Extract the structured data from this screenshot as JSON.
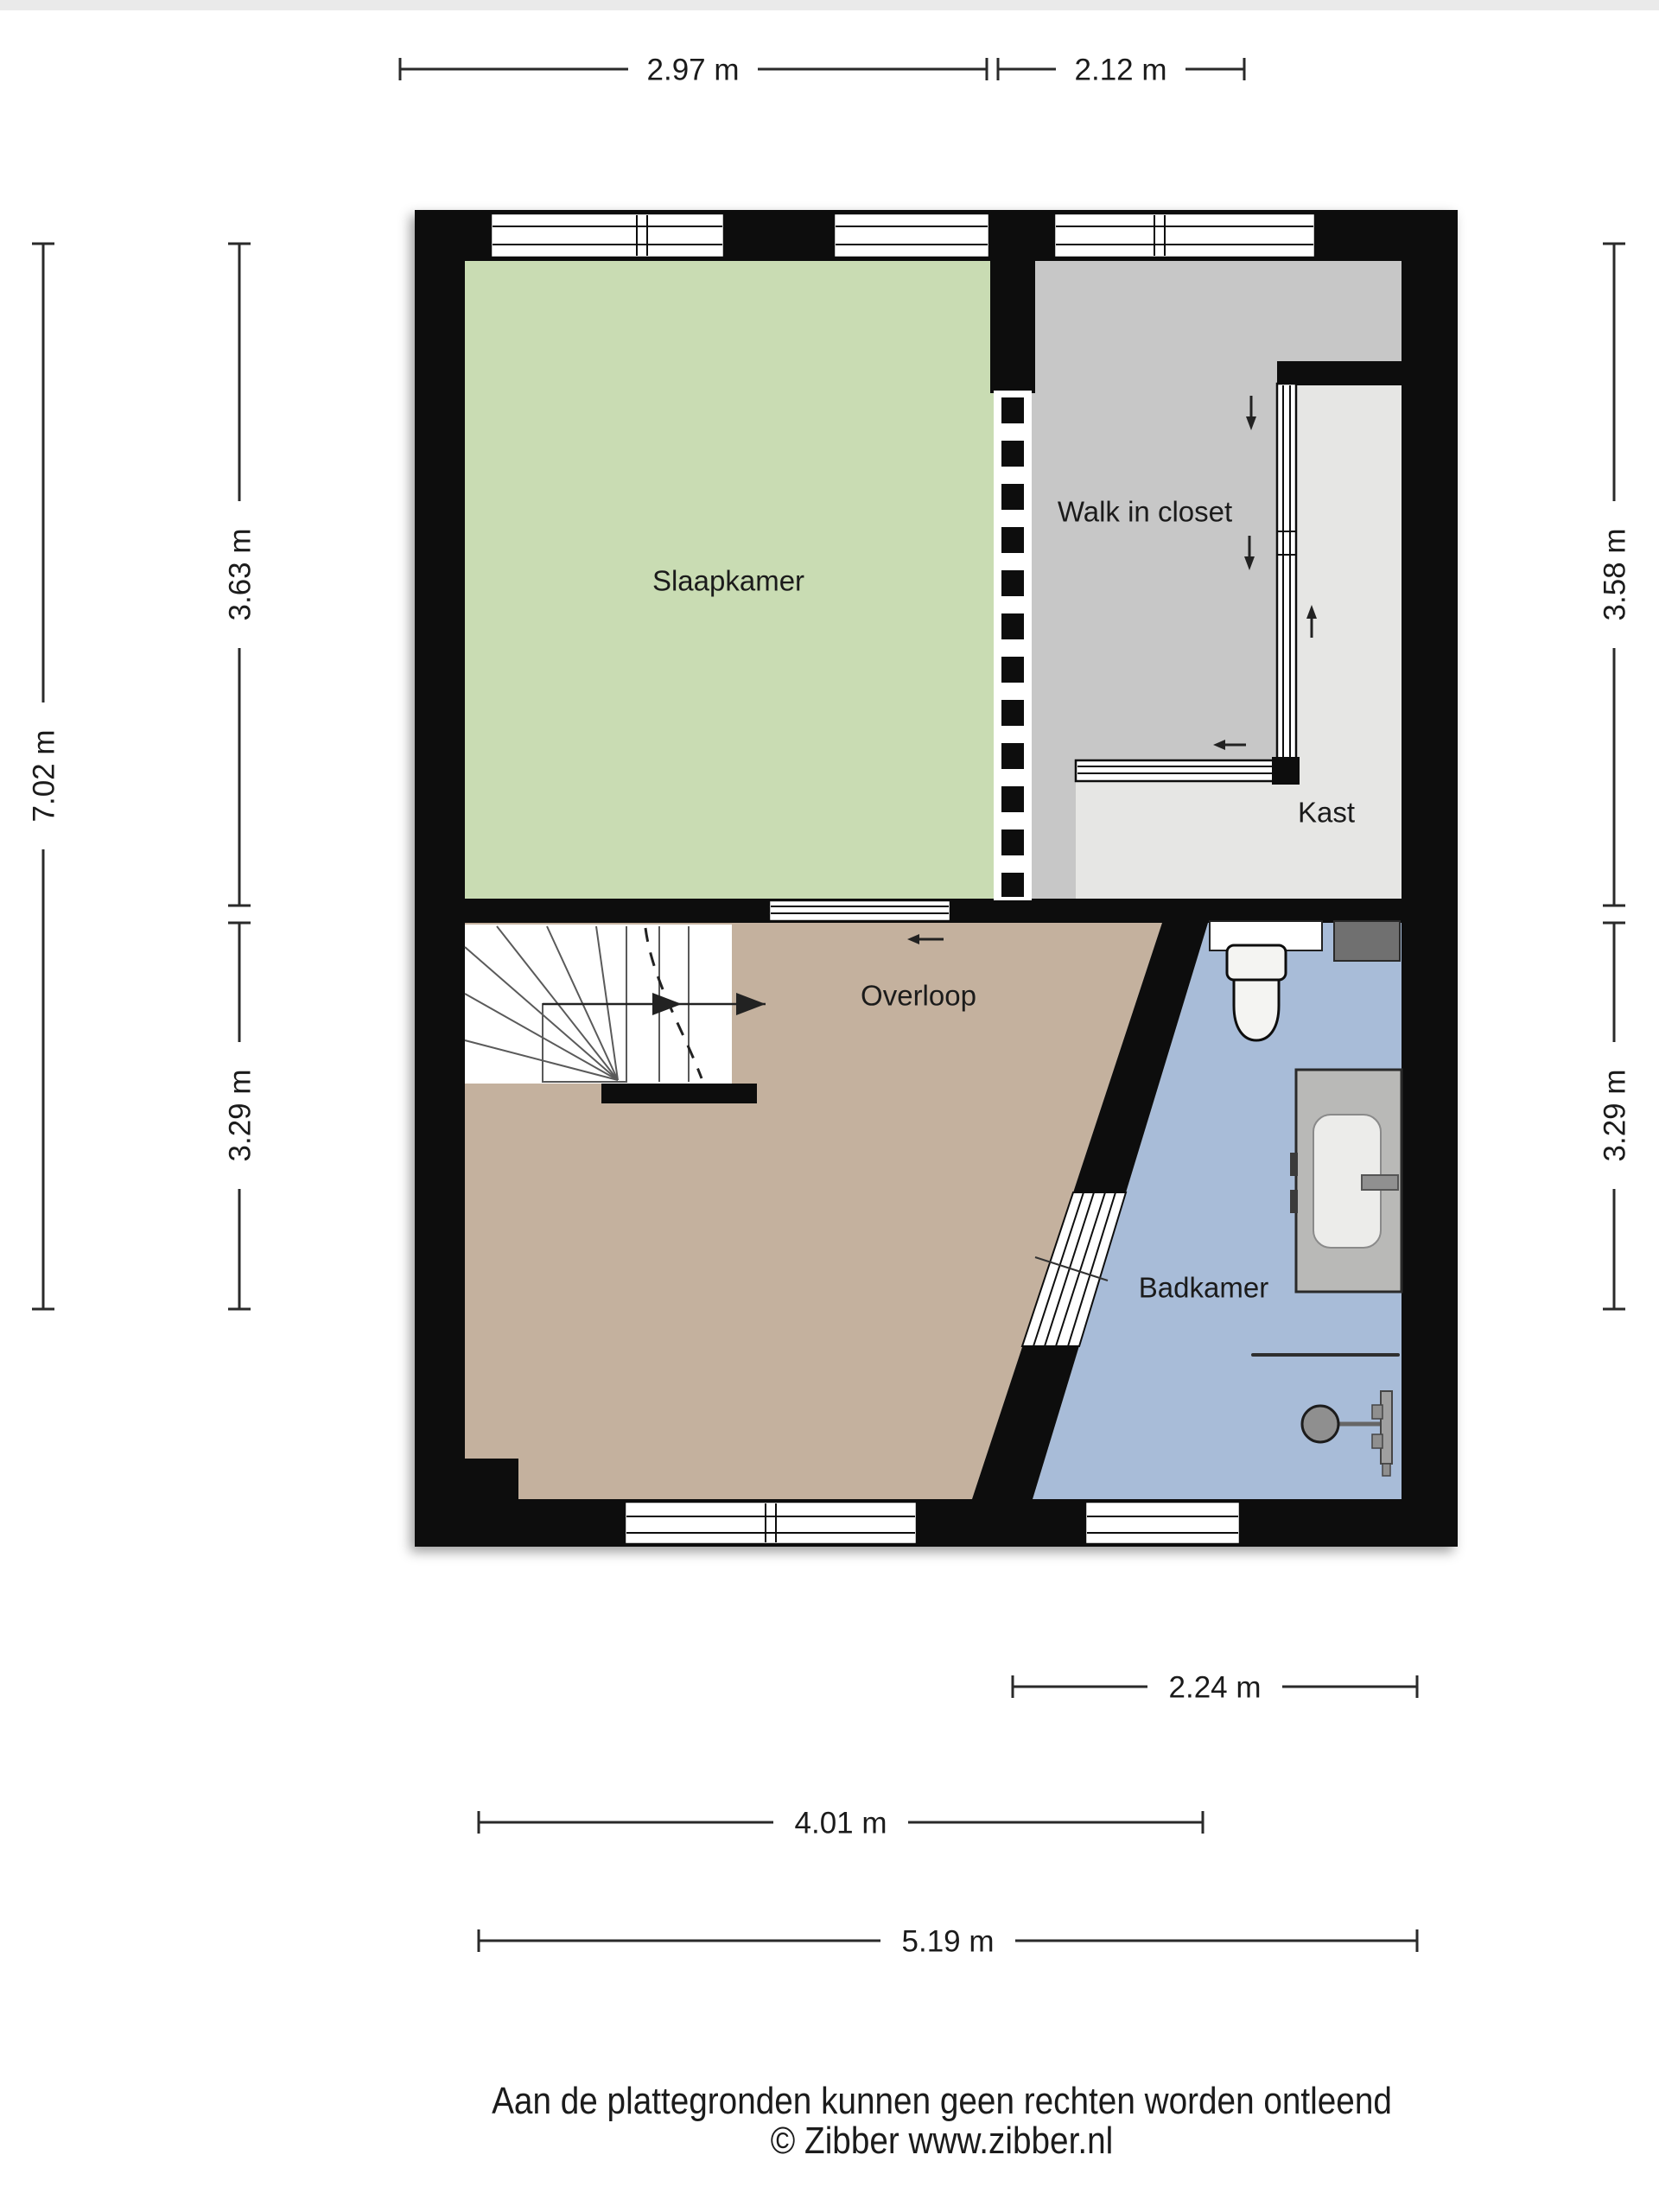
{
  "meta": {
    "type": "floorplan",
    "provider_note": "Zibber floor plan, first floor with bedroom and bathroom"
  },
  "colors": {
    "wall": "#0c0c0c",
    "slaapkamer": "#c9dcb3",
    "walk_in_closet": "#c7c7c7",
    "kast": "#e6e6e4",
    "overloop": "#c4b19e",
    "badkamer": "#a8bcd8",
    "stairs": "#ffffff",
    "dim": "#2a2a2a",
    "text": "#1b1b1b"
  },
  "rooms": [
    {
      "id": "slaapkamer",
      "label": "Slaapkamer"
    },
    {
      "id": "walk-in-closet",
      "label": "Walk in closet"
    },
    {
      "id": "kast",
      "label": "Kast"
    },
    {
      "id": "overloop",
      "label": "Overloop"
    },
    {
      "id": "badkamer",
      "label": "Badkamer"
    }
  ],
  "dimensions": {
    "top": [
      {
        "label": "2.97 m"
      },
      {
        "label": "2.12 m"
      }
    ],
    "left": [
      {
        "label": "7.02 m"
      },
      {
        "label": "3.63 m"
      },
      {
        "label": "3.29 m"
      }
    ],
    "right": [
      {
        "label": "3.58 m"
      },
      {
        "label": "3.29 m"
      }
    ],
    "bottom": [
      {
        "label": "2.24 m"
      },
      {
        "label": "4.01 m"
      },
      {
        "label": "5.19 m"
      }
    ]
  },
  "footer": {
    "disclaimer": "Aan de plattegronden kunnen geen rechten worden ontleend",
    "copyright": "© Zibber www.zibber.nl"
  }
}
